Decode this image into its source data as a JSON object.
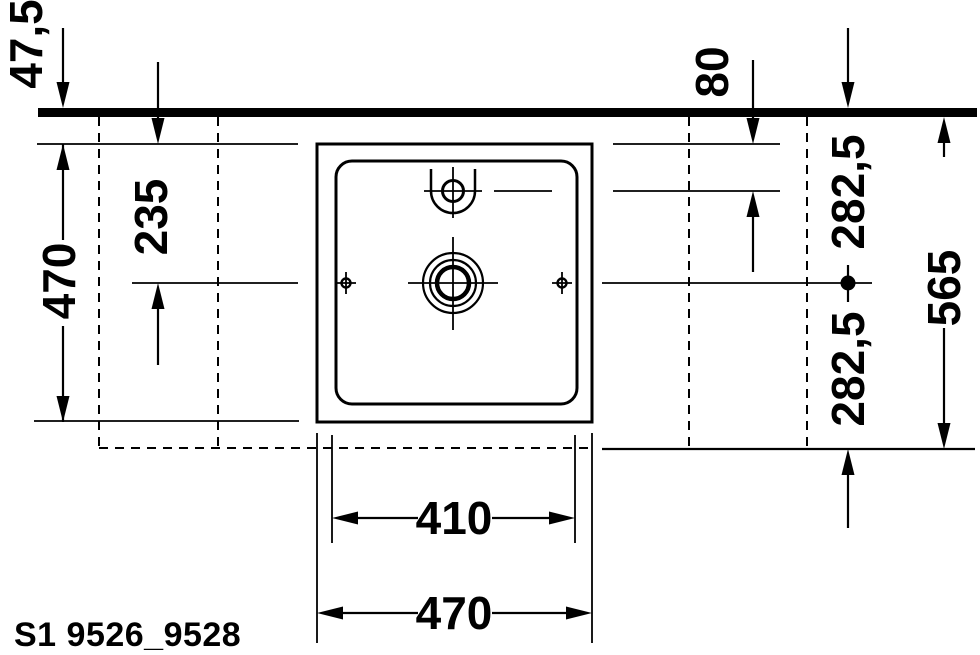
{
  "drawing": {
    "product_code": "S1 9526_9528",
    "dimension_labels": {
      "edge_offset": "47,5",
      "basin_top_to_center": "235",
      "basin_outer_depth": "470",
      "edge_to_faucet_hole": "80",
      "edge_to_center": "282,5",
      "center_to_back": "282,5",
      "edge_to_back_total": "565",
      "inner_width": "410",
      "outer_width": "470"
    },
    "colors": {
      "ink": "#000000",
      "paper": "#ffffff"
    }
  }
}
